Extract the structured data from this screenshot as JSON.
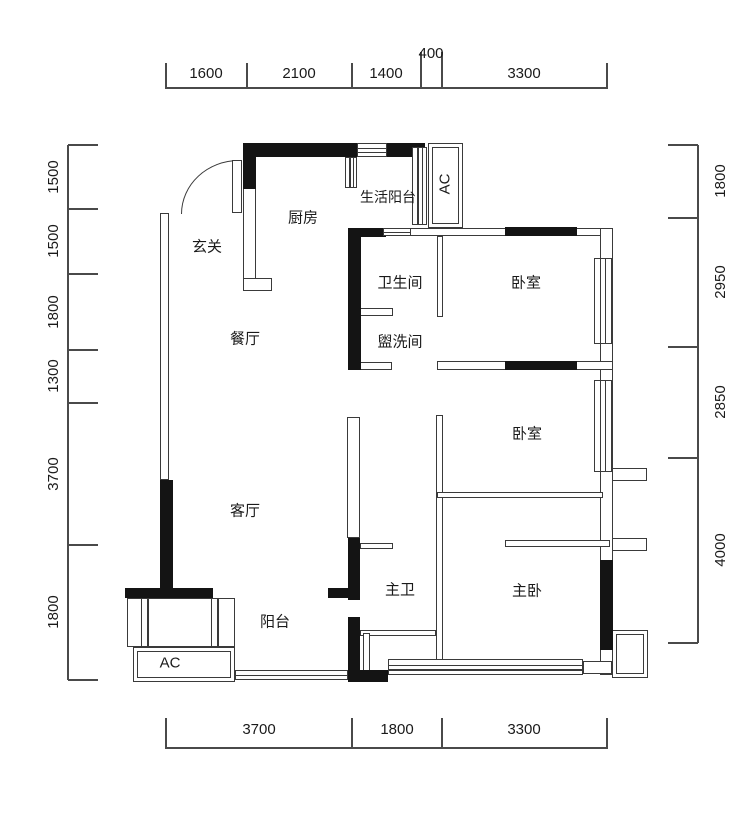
{
  "floor_plan": {
    "room_labels": {
      "entry": "玄关",
      "kitchen": "厨房",
      "living_balcony": "生活阳台",
      "ac_top": "AC",
      "bathroom": "卫生间",
      "bedroom1": "卧室",
      "dining": "餐厅",
      "washroom": "盥洗间",
      "bedroom2": "卧室",
      "living": "客厅",
      "master_bath": "主卫",
      "master_bedroom": "主卧",
      "balcony": "阳台",
      "ac_bottom": "AC"
    },
    "dimensions": {
      "top": [
        "1600",
        "2100",
        "1400",
        "400",
        "3300"
      ],
      "bottom": [
        "3700",
        "1800",
        "3300"
      ],
      "left": [
        "1500",
        "1500",
        "1800",
        "1300",
        "3700",
        "1800"
      ],
      "right": [
        "1800",
        "2950",
        "2850",
        "4000"
      ]
    },
    "colors": {
      "wall": "#141414",
      "thin_wall_line": "#3a3a3a",
      "dimension_line": "#4a4a4a",
      "label_text": "#1a1a1a",
      "background": "#ffffff"
    }
  }
}
